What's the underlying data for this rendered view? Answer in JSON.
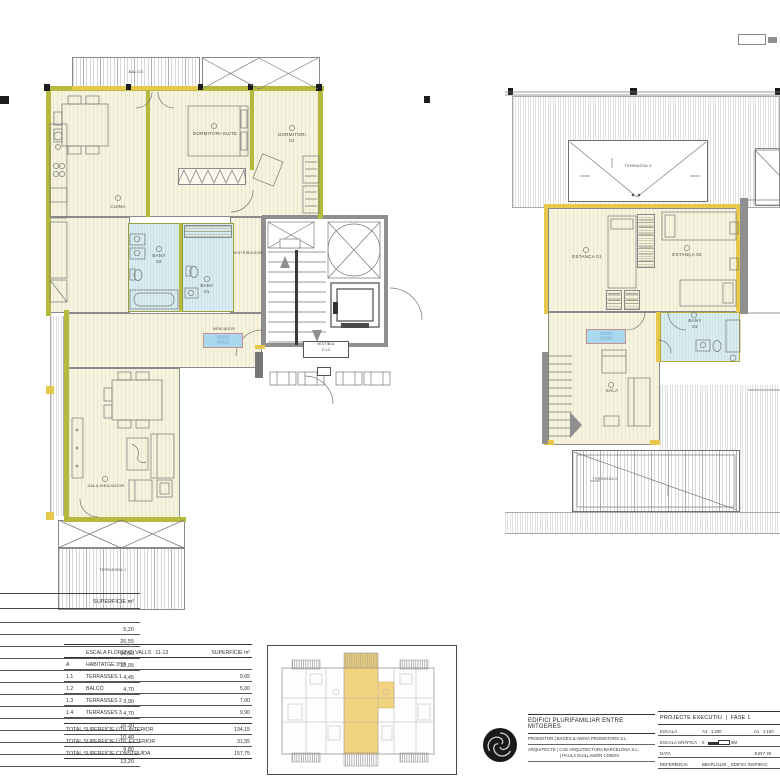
{
  "plan_left": {
    "balco": "BALCÓ",
    "cuina": "CUINA",
    "dormitori_suite": "DORMITORI-SUITE",
    "dormitori_01": "DORMITORI 01",
    "bany_02": "BANY 02",
    "bany_01": "BANY 01",
    "distribuidor": "DISTRIBUIDOR",
    "menjador": "MENJADOR",
    "vestibul_line1": "VESTÍBUL",
    "vestibul_line2": "P-13",
    "sala_menjador": "SALA-MENJADOR",
    "terrassa_1": "TERRASSA 1",
    "area_chip_line1": "░░░░░░",
    "area_chip_line2": "░░░░░░"
  },
  "plan_right": {
    "terrassa_3": "TERRASSA 3",
    "estanca_01": "ESTANÇA 01",
    "estanca_02": "ESTANÇA 02",
    "bany_03": "BANY 03",
    "sala": "SALA",
    "terrassa_2": "TERRASSA 2",
    "area_chip_line1": "░░░░░░",
    "area_chip_line2": "░░░░░░"
  },
  "left_table": {
    "header": "SUPERFÍCIE m²",
    "values": [
      "5,20",
      "26,55",
      "16,90",
      "18,05",
      "4,45",
      "4,70",
      "3,90",
      "4,70",
      "16,30",
      "10,40",
      "9,80",
      "13,20"
    ]
  },
  "summary_table": {
    "header_left": "ESCALA FLORENCI VALLS   11-13",
    "header_right": "SUPERFÍCIE m²",
    "section_code": "A",
    "section_label": "HABITATGE 3º2ª",
    "rows": [
      {
        "code": "1.1",
        "label": "TERRASSES  1",
        "value": "9,65"
      },
      {
        "code": "1.2",
        "label": "BALCÓ",
        "value": "5,00"
      },
      {
        "code": "1.3",
        "label": "TERRASSES  2",
        "value": "7,00"
      },
      {
        "code": "1.4",
        "label": "TERRASSES  3",
        "value": "9,90"
      }
    ],
    "totals": [
      {
        "label": "TOTAL SUPERFÍCIE ÚTIL INTERIOR",
        "value": "134,15"
      },
      {
        "label": "TOTAL SUPERFÍCIE ÚTIL EXTERIOR",
        "value": "31,55"
      },
      {
        "label": "TOTAL SUPERFÍCIE CONSTRUÏDA",
        "value": "157,75"
      }
    ]
  },
  "title_block": {
    "project_title": "EDIFICI PLURIFAMILIAR ENTRE MITGERES",
    "promotor_label": "PROMOTOR",
    "promotor_value": "|  BAGES & ANOIA PROMOTORS S.L.",
    "arquitecte_label": "ARQUITECTE",
    "arquitecte_value1": "|  C4G ARQUITECTURA BARCELONA S.L.",
    "arquitecte_value2": "|  PAULA GUILLAMÓN COBOS",
    "phase": "PROJECTE EXECUTIU  |  FASE 1",
    "escala_label": "ESCALA",
    "escala_a3": "A3   1:200",
    "escala_a1": "A1   1:100",
    "escala_grafica_label": "ESCALA GRÀFICA",
    "grafica_0": "0",
    "grafica_5": "5M",
    "data_label": "DATA",
    "data_value": "JUNY 20",
    "referencia_label": "REFERÈNCIA",
    "referencia_value": "BBAPL/1120 _ EDIFICI INSPIRAC"
  }
}
